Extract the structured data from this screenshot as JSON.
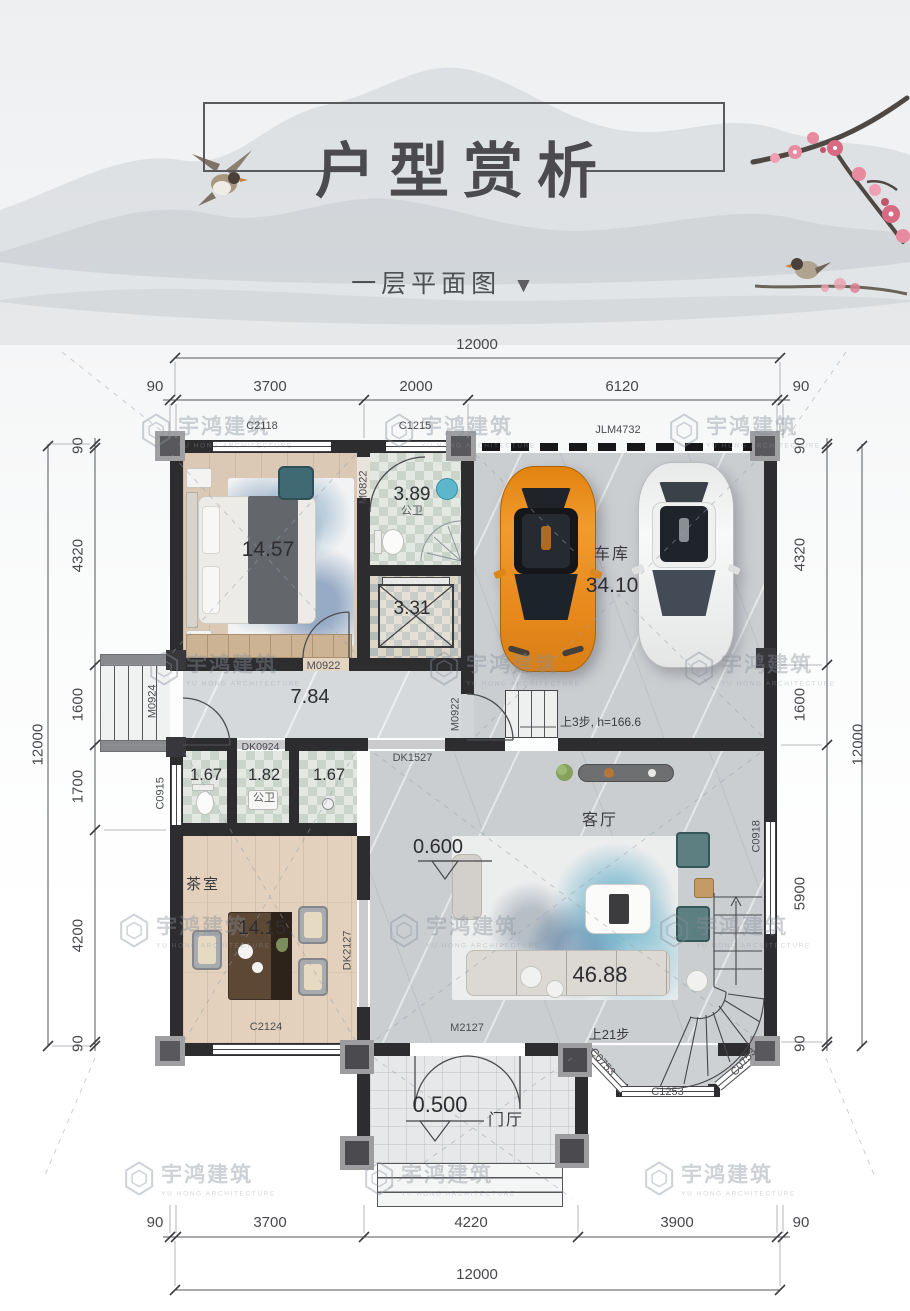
{
  "header": {
    "title": "户型赏析",
    "subtitle": "一层平面图",
    "arrow": "▼"
  },
  "watermark": {
    "name": "宇鸿建筑",
    "name_en": "YU HONG ARCHITECTURE"
  },
  "dimensions": {
    "top": {
      "overall": "12000",
      "segments": [
        "90",
        "3700",
        "2000",
        "6120",
        "90"
      ]
    },
    "bottom": {
      "overall": "12000",
      "segments": [
        "90",
        "3700",
        "4220",
        "3900",
        "90"
      ]
    },
    "left": {
      "overall": "12000",
      "segments": [
        "90",
        "4320",
        "1600",
        "1700",
        "4200",
        "90"
      ]
    },
    "right": {
      "overall": "12000",
      "segments": [
        "90",
        "4320",
        "1600",
        "5900",
        "90"
      ]
    }
  },
  "rooms": {
    "bedroom": {
      "area": "14.57"
    },
    "bathroom": {
      "label": "公卫",
      "area": "3.89"
    },
    "shaft": {
      "area": "3.31"
    },
    "garage": {
      "name": "车库",
      "area": "34.10"
    },
    "hallway": {
      "area": "7.84"
    },
    "wc_left": {
      "area": "1.67"
    },
    "wc_mid": {
      "label": "公卫",
      "area": "1.82"
    },
    "wc_right": {
      "area": "1.67"
    },
    "tea_room": {
      "name": "茶室",
      "area": "14.15"
    },
    "living": {
      "name": "客厅",
      "area": "46.88",
      "level": "0.600"
    },
    "foyer": {
      "name": "门厅",
      "level": "0.500"
    }
  },
  "openings": {
    "c2118": "C2118",
    "c1215": "C1215",
    "jlm4732": "JLM4732",
    "m0822": "M0822",
    "m0922_bedroom": "M0922",
    "m0922_garage": "M0922",
    "m0924": "M0924",
    "dk0924": "DK0924",
    "dk1527": "DK1527",
    "c0915": "C0915",
    "c0918": "C0918",
    "dk2127": "DK2127",
    "c2124": "C2124",
    "m2127": "M2127",
    "c0753_left": "C0753",
    "c1253": "C1253",
    "c0753_right": "C0753"
  },
  "annotations": {
    "stair_small": "上3步, h=166.6",
    "stair_main": "上21步"
  },
  "colors": {
    "wall": "#2d2d30",
    "wood_floor": "#dbc9b6",
    "tile_floor": "#e4e8e2",
    "marble_floor": "#cbced1",
    "car_orange": "#e0861c",
    "car_white": "#f0f1f1",
    "chair_teal": "#5d7f82",
    "blossom_pink": "#e2798f",
    "title_gray": "#4a4a4e",
    "watermark_gray": "#8f969c"
  }
}
